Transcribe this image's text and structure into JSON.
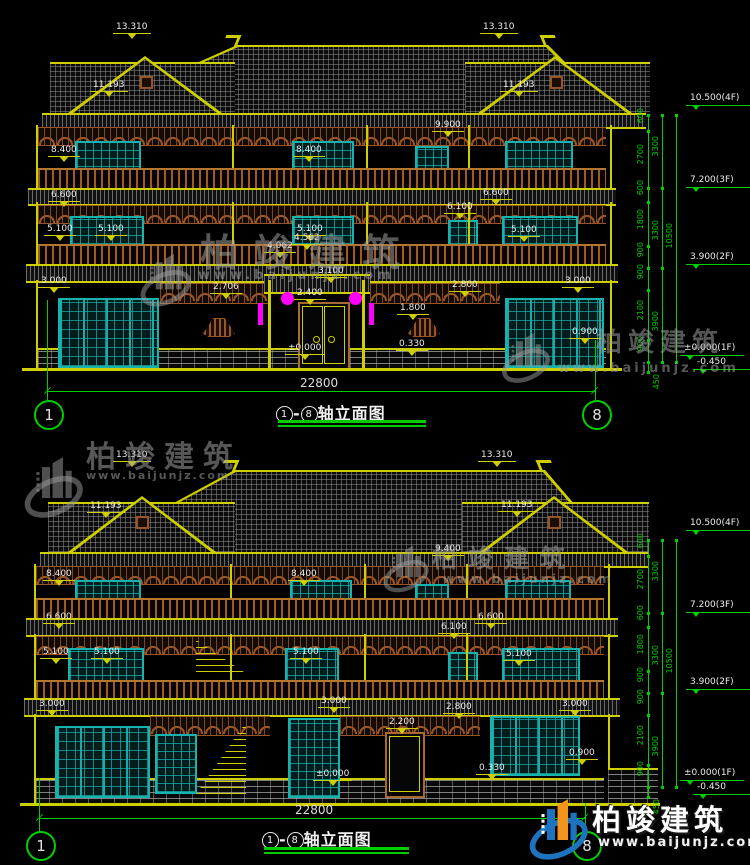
{
  "labels": {
    "13310": "13.310",
    "11193": "11.193",
    "9900": "9.900",
    "9400": "9.400",
    "8400": "8.400",
    "6600": "6.600",
    "6100": "6.100",
    "5100": "5.100",
    "4562": "4.562",
    "4062": "4.062",
    "3100": "3.100",
    "3000": "3.000",
    "2800": "2.800",
    "2706": "2.706",
    "2400": "2.400",
    "2200": "2.200",
    "1800": "1.800",
    "900": "0.900",
    "330": "0.330",
    "zero": "±0.000"
  },
  "chain": {
    "f4": "10.500(4F)",
    "f3": "7.200(3F)",
    "f2": "3.900(2F)",
    "f1": "±0.000(1F)",
    "neg": "-0.450",
    "s600": "600",
    "s2700": "2700",
    "s1800": "1800",
    "s900": "900",
    "s2100": "2100",
    "s3300": "3300",
    "s3900": "3900",
    "total": "10500",
    "s450": "450"
  },
  "drawing": {
    "width_label": "22800",
    "axis_start": "1",
    "axis_end": "8",
    "dash": "-",
    "title_text": "轴立面图"
  },
  "watermark": {
    "name": "柏竣建筑",
    "url": "www.baijunjz.com"
  },
  "colors": {
    "line_yellow": "#cfcf00",
    "dim_green": "#00d000",
    "window_teal": "#17b3ae",
    "wood_brown": "#9a5526",
    "lantern_magenta": "#ff00ff",
    "logo_blue": "#1e73be",
    "logo_orange": "#f5941d"
  }
}
